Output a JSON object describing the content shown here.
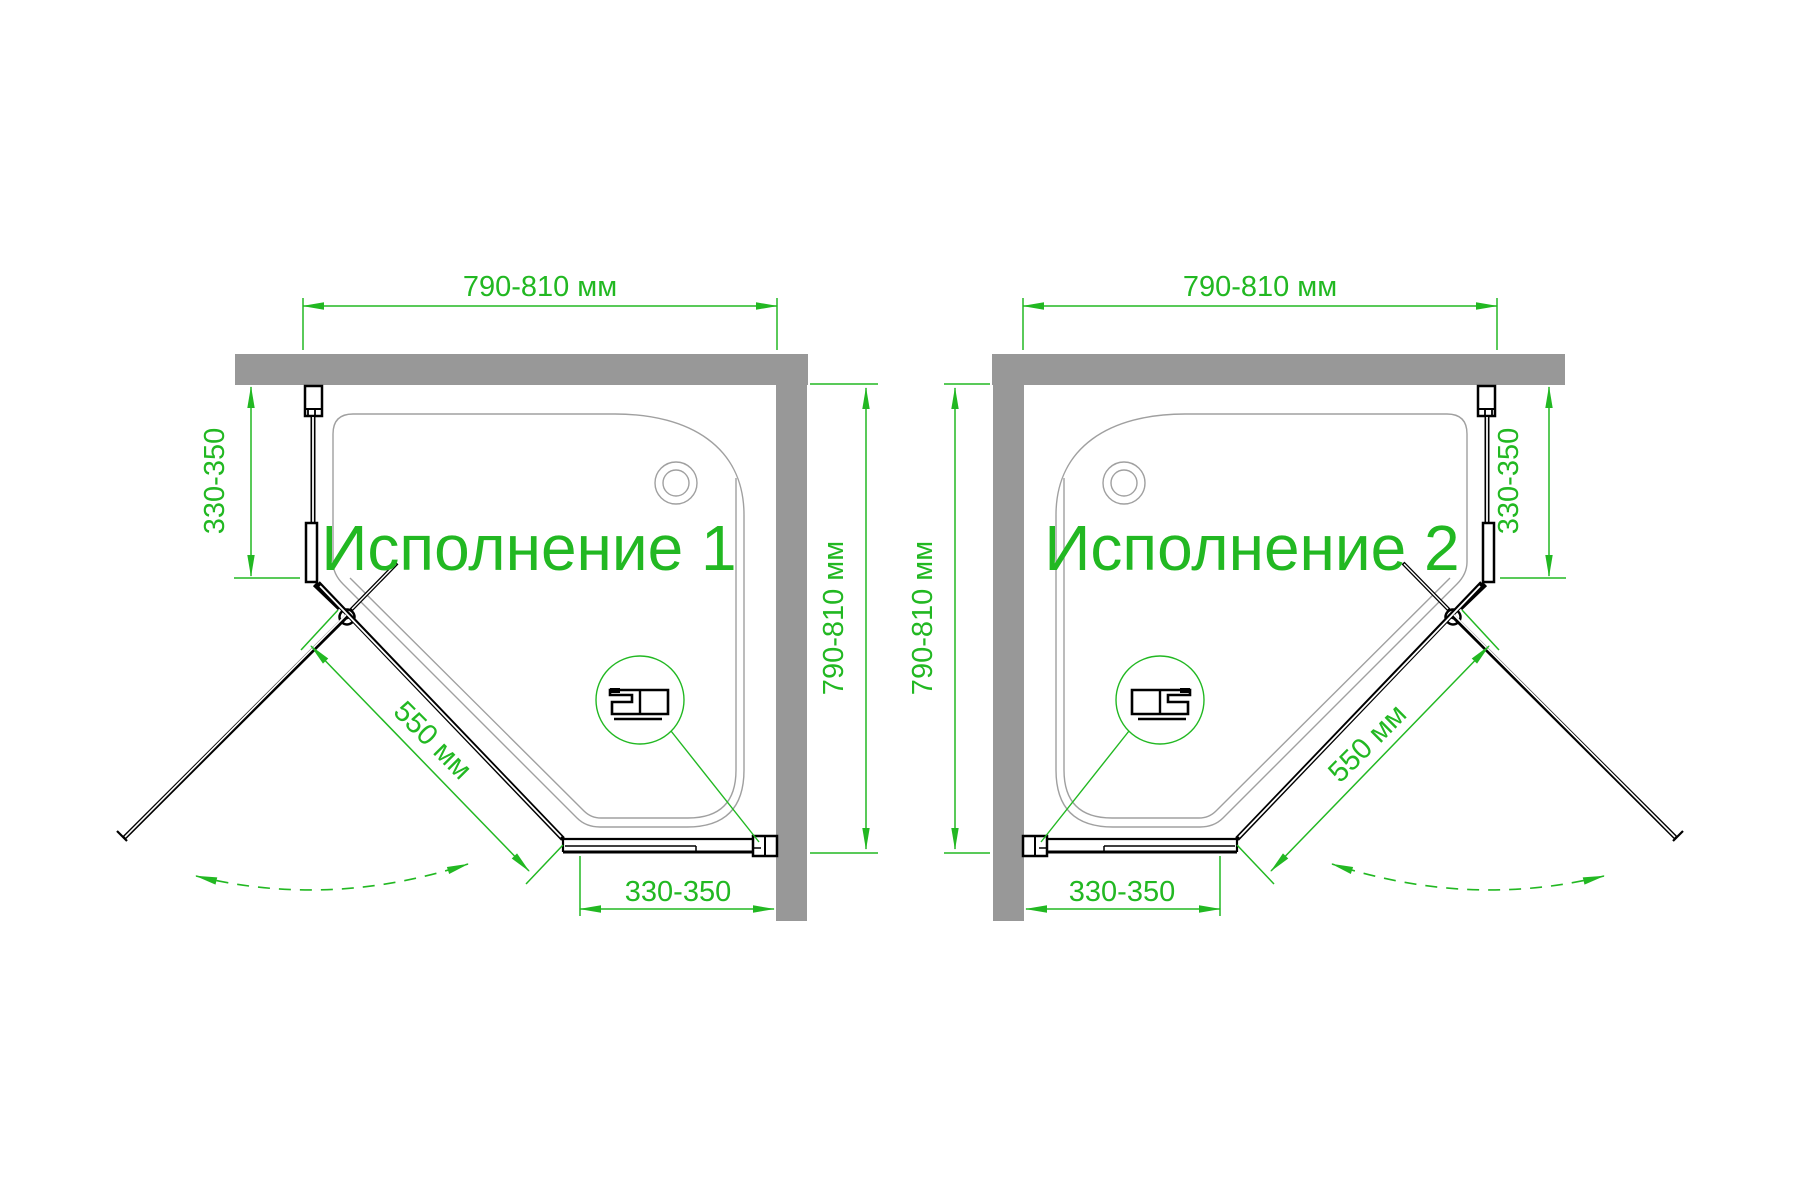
{
  "views": [
    {
      "title": "Исполнение 1",
      "dim_width": "790-810 мм",
      "dim_depth": "790-810 мм",
      "dim_side": "330-350",
      "dim_bottom": "330-350",
      "dim_door": "550 мм"
    },
    {
      "title": "Исполнение 2",
      "dim_width": "790-810 мм",
      "dim_depth": "790-810 мм",
      "dim_side": "330-350",
      "dim_bottom": "330-350",
      "dim_door": "550 мм"
    }
  ],
  "colors": {
    "dimension_green": "#22b822",
    "wall_gray": "#989898",
    "tray_outline_gray": "#a0a0a0",
    "linework_black": "#000000",
    "background": "#ffffff"
  }
}
